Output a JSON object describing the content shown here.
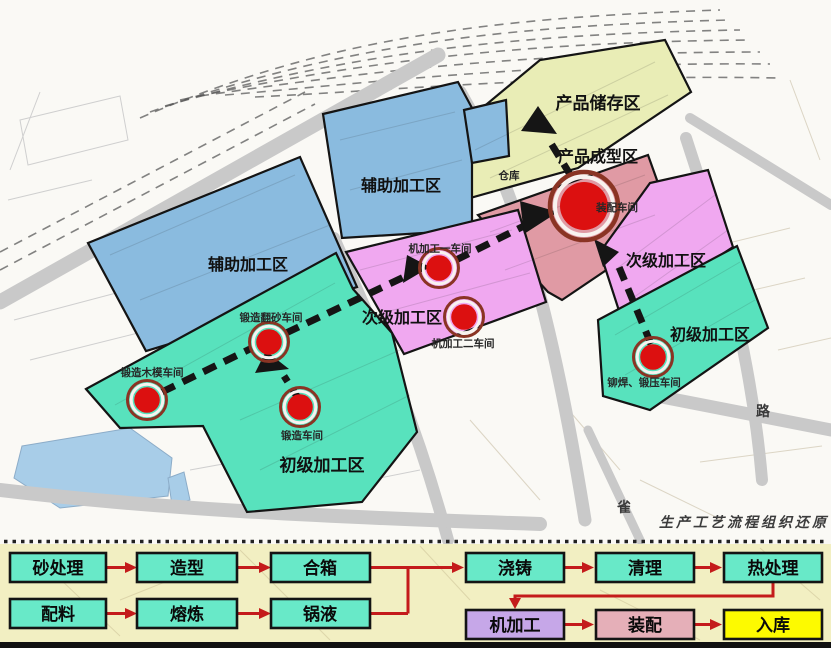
{
  "title": "factory-site-plan",
  "zones": {
    "aux_upper": "辅助加工区",
    "aux_lower": "辅助加工区",
    "secondary_mid": "次级加工区",
    "secondary_right": "次级加工区",
    "primary_left": "初级加工区",
    "primary_right": "初级加工区",
    "storage": "产品储存区",
    "forming": "产品成型区"
  },
  "workshops": {
    "warehouse": "仓库",
    "assembly": "装配车间",
    "machining1": "机加工一车间",
    "machining2": "机加工二车间",
    "wood_mold": "锻造木模车间",
    "sand_casting": "锻造翻砂车间",
    "forging": "锻造车间",
    "rivet_press": "铆焊、锻压车间"
  },
  "annotations": {
    "road": "路",
    "bird": "雀",
    "caption": "生产工艺流程组织还原"
  },
  "flow": {
    "sand_treatment": "砂处理",
    "molding": "造型",
    "box_assembly": "合箱",
    "batching": "配料",
    "smelting": "熔炼",
    "molten_metal": "锅液",
    "pouring": "浇铸",
    "cleaning": "清理",
    "heat_treatment": "热处理",
    "machining": "机加工",
    "assembly": "装配",
    "warehousing": "入库"
  },
  "colors": {
    "teal_zone": "#58e2bd",
    "blue_zone": "#8abbdf",
    "pink_zone": "#f0a8f0",
    "red_zone": "#e09aa4",
    "storage_zone": "#e9edb6",
    "lake": "#a8cde8",
    "road_gray": "#c9c9c9",
    "marker_red": "#dc1010",
    "marker_ring": "#8a3424",
    "flow_box_teal": "#68e9c8",
    "flow_box_purple": "#c6a7e8",
    "flow_box_pink": "#e5afb8",
    "flow_box_yellow": "#fdfa00",
    "flow_arrow_red": "#c41b1b",
    "panel_bg": "#f2efc2"
  }
}
